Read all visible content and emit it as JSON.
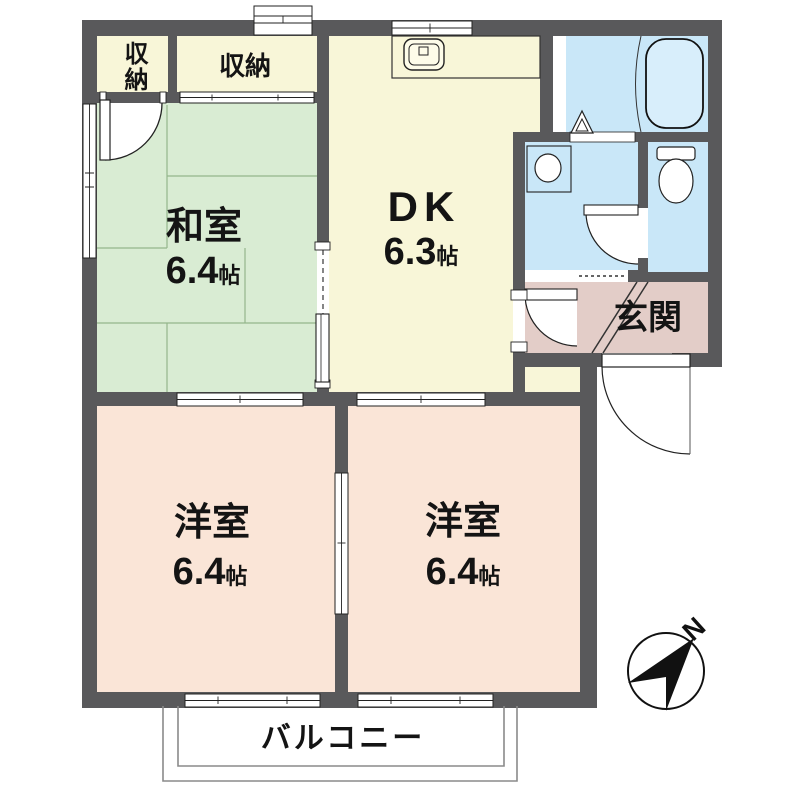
{
  "rooms": {
    "washitsu": {
      "name": "和室",
      "size_num": "6.4",
      "size_unit": "帖"
    },
    "dk": {
      "name": "DK",
      "size_num": "6.3",
      "size_unit": "帖"
    },
    "western_left": {
      "name": "洋室",
      "size_num": "6.4",
      "size_unit": "帖"
    },
    "western_right": {
      "name": "洋室",
      "size_num": "6.4",
      "size_unit": "帖"
    },
    "closet_small": {
      "name": "収納"
    },
    "closet_wide": {
      "name": "収納"
    },
    "genkan": {
      "name": "玄関"
    },
    "balcony": {
      "name": "バルコニー"
    }
  },
  "compass": {
    "north_label": "N"
  },
  "colors": {
    "wall": "#59595b",
    "cream": "#f8f6d8",
    "tatami": "#d9ecd3",
    "tatamiLine": "#94b68c",
    "western": "#fae5d7",
    "wet": "#c9e7f8",
    "wetFixture": "#d8eefb",
    "genkan": "#e3cdc8",
    "ink": "#141414",
    "thin": "#8a8a8a"
  }
}
